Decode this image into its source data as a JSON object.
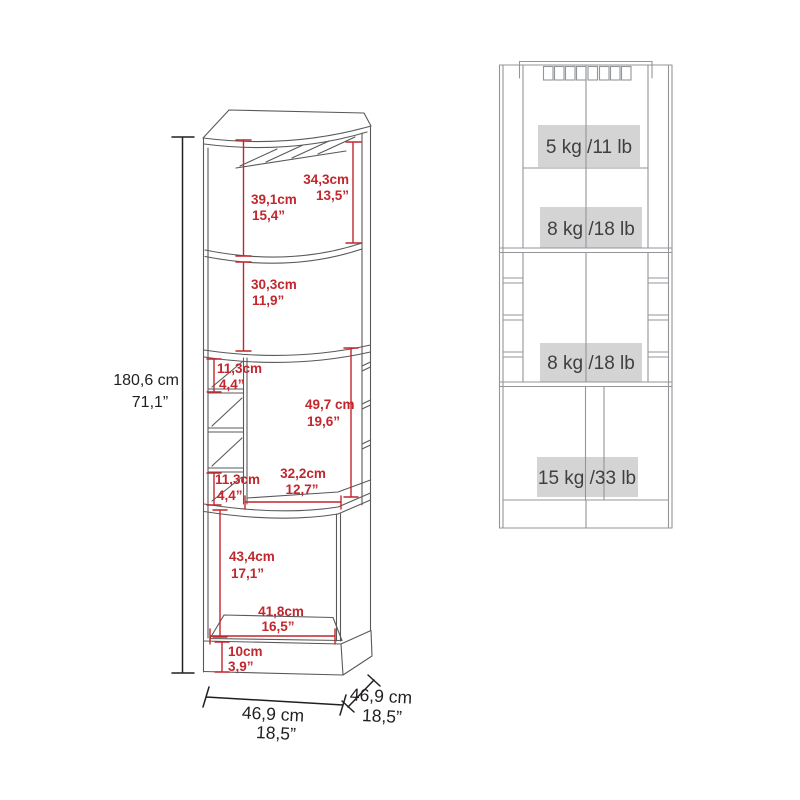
{
  "left_view": {
    "overall_height": {
      "cm": "180,6 cm",
      "inches": "71,1”"
    },
    "dims": {
      "glass_rack": {
        "cm": "34,3cm",
        "inches": "13,5”"
      },
      "top_section": {
        "cm": "39,1cm",
        "inches": "15,4”"
      },
      "second_section": {
        "cm": "30,3cm",
        "inches": "11,9”"
      },
      "cubby_upper": {
        "cm": "11,3cm",
        "inches": "4,4”"
      },
      "middle_section": {
        "cm": "49,7 cm",
        "inches": "19,6”"
      },
      "cubby_lower": {
        "cm": "11,3cm",
        "inches": "4,4”"
      },
      "middle_width": {
        "cm": "32,2cm",
        "inches": "12,7”"
      },
      "bottom_cabinet": {
        "cm": "43,4cm",
        "inches": "17,1”"
      },
      "bottom_width": {
        "cm": "41,8cm",
        "inches": "16,5”"
      },
      "base_height": {
        "cm": "10cm",
        "inches": "3,9”"
      },
      "overall_width": {
        "cm": "46,9 cm",
        "inches": "18,5”"
      },
      "overall_depth": {
        "cm": "46,9 cm",
        "inches": "18,5”"
      }
    }
  },
  "right_view": {
    "capacities": [
      "5 kg /11 lb",
      "8 kg /18 lb",
      "8 kg /18 lb",
      "15 kg /33 lb"
    ]
  },
  "colors": {
    "dimension_red": "#c1272d",
    "dimension_black": "#231f20",
    "drawing_line_gray": "#595959",
    "elevation_line_gray": "#939598",
    "capacity_box_fill": "#d4d4d4",
    "capacity_text": "#3f3f3f",
    "background": "#ffffff"
  }
}
